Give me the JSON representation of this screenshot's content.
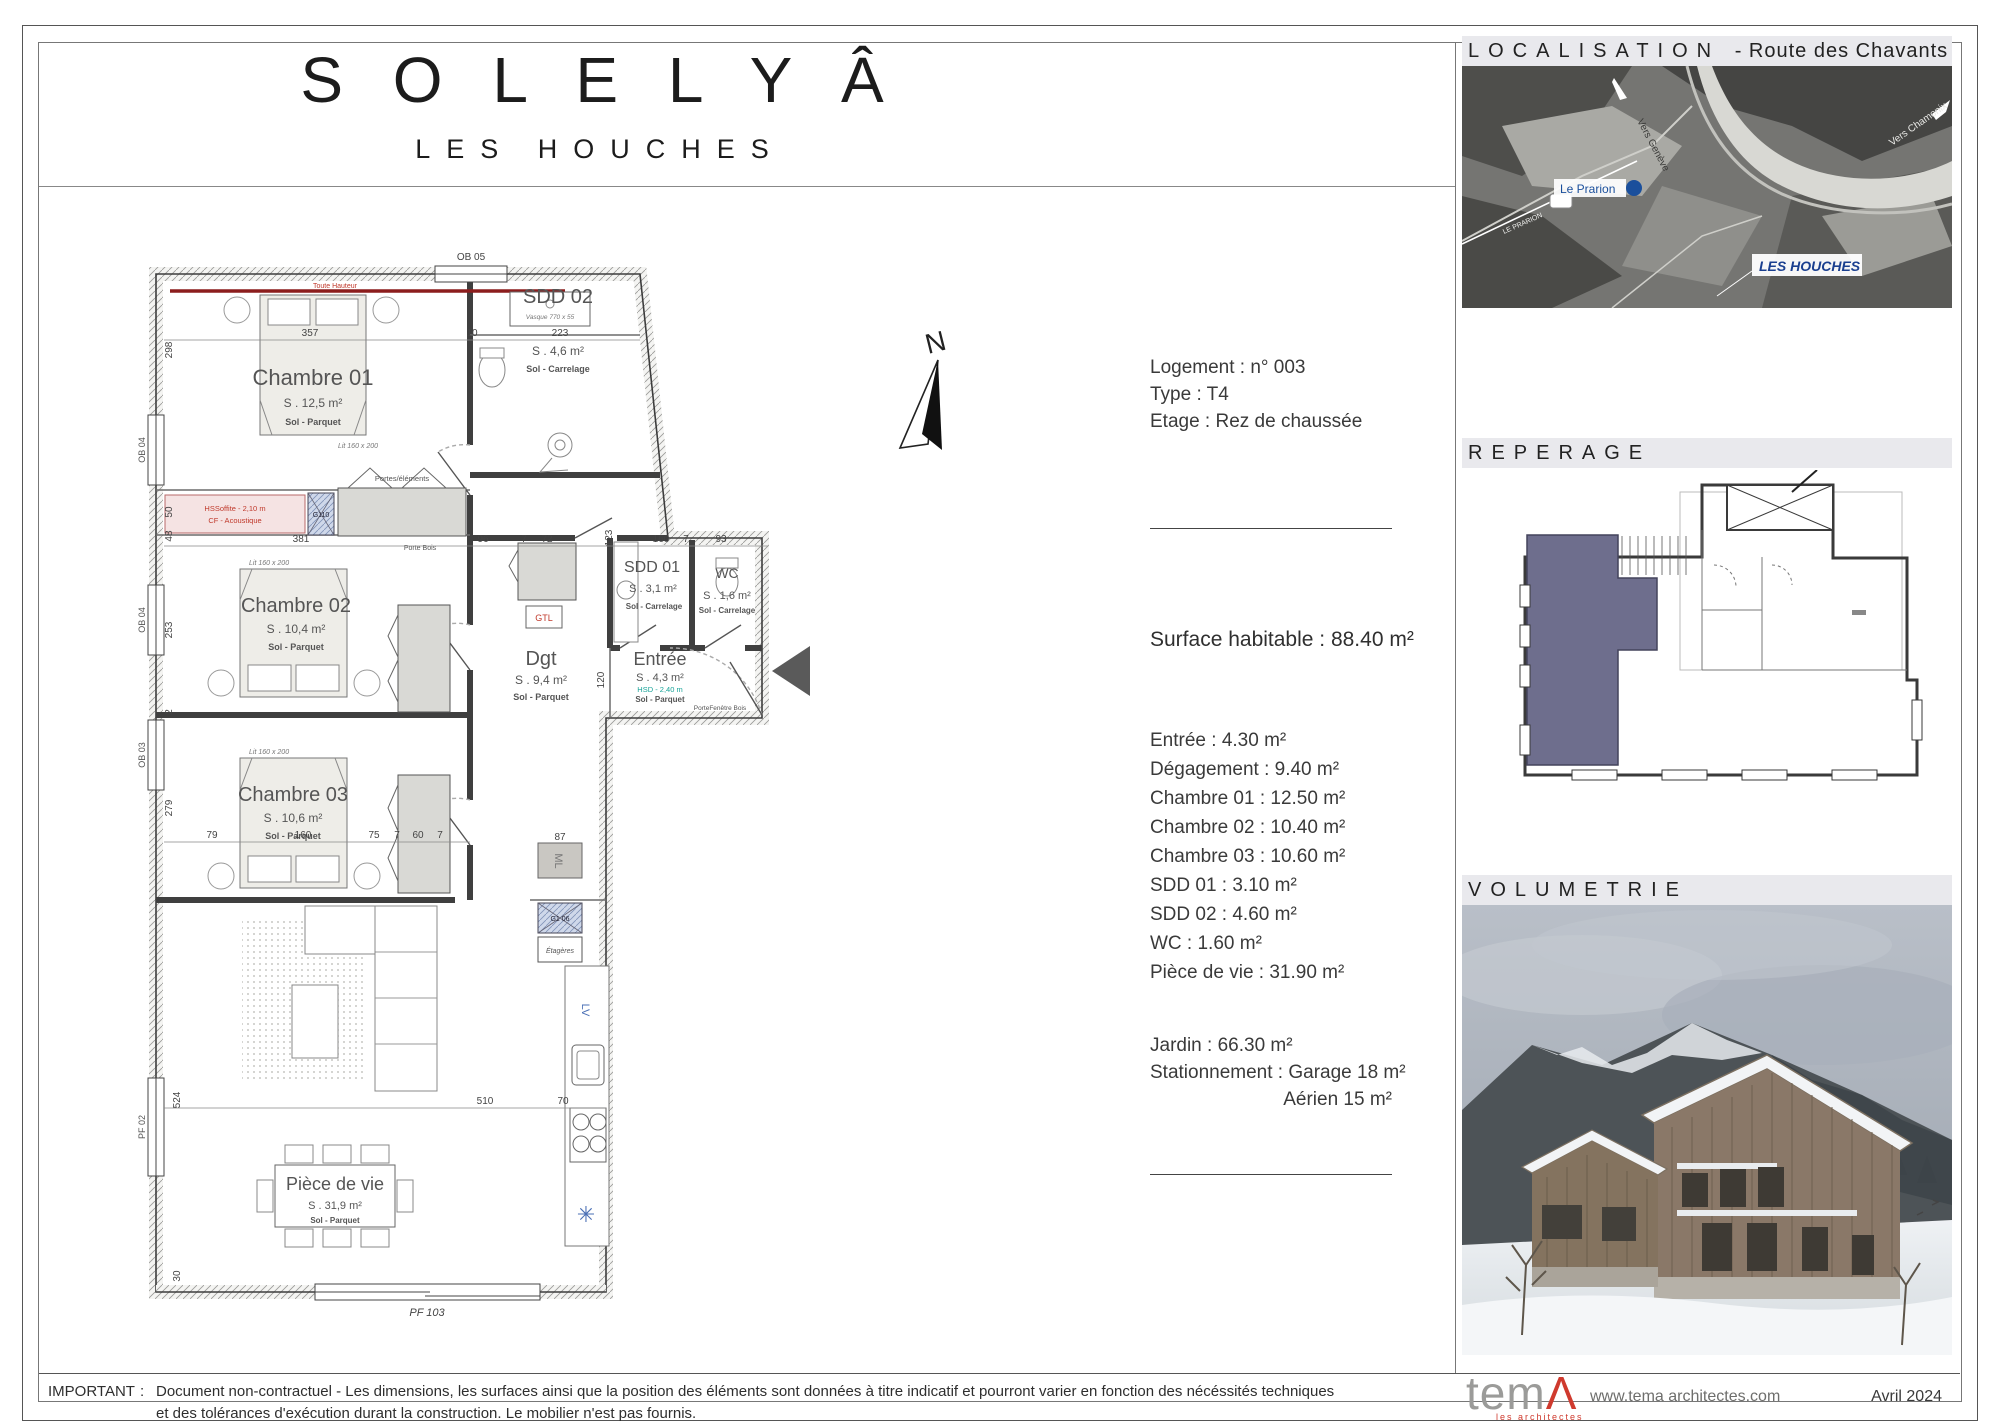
{
  "header": {
    "title": "S O L E L Y Â",
    "subtitle": "LES HOUCHES"
  },
  "info": {
    "logement": "Logement : n° 003",
    "type": "Type : T4",
    "etage": "Etage : Rez de chaussée",
    "surface": "Surface habitable : 88.40 m²",
    "surfaces": [
      "Entrée : 4.30 m²",
      "Dégagement : 9.40 m²",
      "Chambre 01 : 12.50 m²",
      "Chambre 02 : 10.40 m²",
      "Chambre 03 : 10.60 m²",
      "SDD 01 : 3.10 m²",
      "SDD 02 : 4.60 m²",
      "WC : 1.60 m²",
      "Pièce de vie : 31.90 m²"
    ],
    "jardin": "Jardin : 66.30 m²",
    "stationnement": "Stationnement : Garage 18 m²",
    "aerien": "Aérien 15 m²"
  },
  "sections": {
    "localisation": "LOCALISATION",
    "localisation_suffix": "-  Route des Chavants",
    "reperage": "REPERAGE",
    "volumetrie": "VOLUMETRIE"
  },
  "map": {
    "prarion": "Le Prarion",
    "houches": "LES HOUCHES",
    "geneve": "Vers Genève",
    "chamonix": "Vers Chamonix",
    "cable": "LE PRARION"
  },
  "compass": {
    "n": "N"
  },
  "plan": {
    "rooms": {
      "chambre01": {
        "name": "Chambre 01",
        "area": "S . 12,5 m²",
        "floor": "Sol - Parquet"
      },
      "sdd02": {
        "name": "SDD 02",
        "area": "S . 4,6 m²",
        "floor": "Sol - Carrelage"
      },
      "chambre02": {
        "name": "Chambre 02",
        "area": "S . 10,4 m²",
        "floor": "Sol - Parquet"
      },
      "chambre03": {
        "name": "Chambre 03",
        "area": "S . 10,6 m²",
        "floor": "Sol - Parquet"
      },
      "dgt": {
        "name": "Dgt",
        "area": "S . 9,4 m²",
        "floor": "Sol - Parquet"
      },
      "sdd01": {
        "name": "SDD 01",
        "area": "S . 3,1 m²",
        "floor": "Sol - Carrelage"
      },
      "wc": {
        "name": "WC",
        "area": "S . 1,6 m²",
        "floor": "Sol - Carrelage"
      },
      "entree": {
        "name": "Entrée",
        "area": "S . 4,3 m²",
        "height": "HSD - 2,40 m",
        "floor": "Sol - Parquet"
      },
      "piecedevie": {
        "name": "Pièce de vie",
        "area": "S . 31,9 m²",
        "floor": "Sol - Parquet"
      }
    },
    "windows": {
      "ob05": "OB 05",
      "ob04a": "OB 04",
      "ob04b": "OB 04",
      "ob03": "OB 03",
      "pf02": "PF 02",
      "pf103": "PF 103"
    },
    "annotations": {
      "toute_hauteur": "Toute Hauteur",
      "hsoffite": "HSSoffite - 2,10 m",
      "cf": "CF - Acoustique",
      "gtl": "GTL",
      "ml": "ML",
      "g110": "G110",
      "g106": "G1 06",
      "etageres": "Étagères",
      "lv": "LV",
      "vasque": "Vasque 770 x 55",
      "lit": "Lit 160 x 200",
      "portes": "Portes/éléments",
      "porte_bois": "Porte Bois",
      "porte_fenetre": "PorteFenêtre Bois",
      "asterisk": "✳"
    },
    "dims": {
      "top": [
        "357",
        "10",
        "223"
      ],
      "mid": [
        "381",
        "96",
        "7",
        "72",
        "123",
        "160",
        "7",
        "93"
      ],
      "ch03": [
        "79",
        "160",
        "75",
        "7",
        "60",
        "7"
      ],
      "bottom": [
        "510",
        "70"
      ],
      "v298": "298",
      "v50": "50",
      "v48": "48",
      "v253": "253",
      "v2": "2",
      "v279": "279",
      "v524": "524",
      "v30": "30",
      "v120": "120",
      "d87": "87"
    }
  },
  "footer": {
    "important": "IMPORTANT",
    "sep": ":",
    "line1": "Document non-contractuel - Les dimensions, les surfaces ainsi que la position des éléments sont données à titre indicatif et pourront varier en fonction des nécéssités techniques",
    "line2": "et des tolérances d'exécution durant la construction. Le mobilier n'est pas fournis.",
    "logo": "tem",
    "logo_a": "Λ",
    "logo_sub": "les architectes",
    "url": "www.tema architectes.com",
    "date": "Avril 2024"
  }
}
